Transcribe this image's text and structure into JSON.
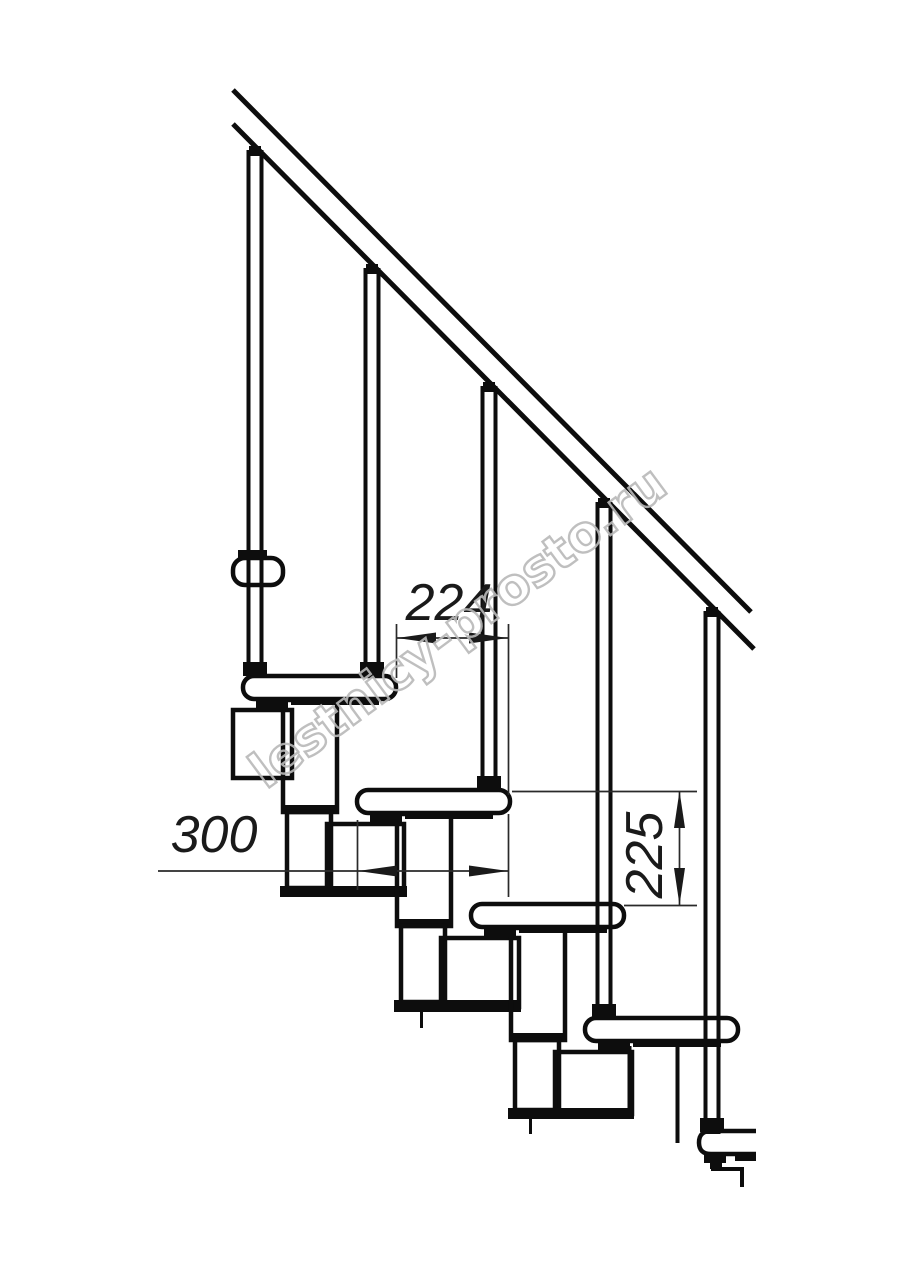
{
  "page": {
    "background": "#ffffff"
  },
  "drawing": {
    "type": "staircase-side-view-technical-drawing",
    "dimensions": {
      "run": {
        "label": "224",
        "value": 224,
        "unit": "mm",
        "orientation": "horizontal"
      },
      "tread_depth": {
        "label": "300",
        "value": 300,
        "unit": "mm",
        "orientation": "horizontal"
      },
      "rise": {
        "label": "225",
        "value": 225,
        "unit": "mm",
        "orientation": "vertical"
      }
    },
    "counts": {
      "treads_visible": 5,
      "balusters_visible": 5,
      "handrail_lines": 2
    },
    "colors": {
      "line": "#0d0d0d",
      "dimension": "#2a2a2a",
      "watermark": "#b9b9b9"
    }
  },
  "watermark": {
    "text": "lestnicy-prosto.ru"
  }
}
